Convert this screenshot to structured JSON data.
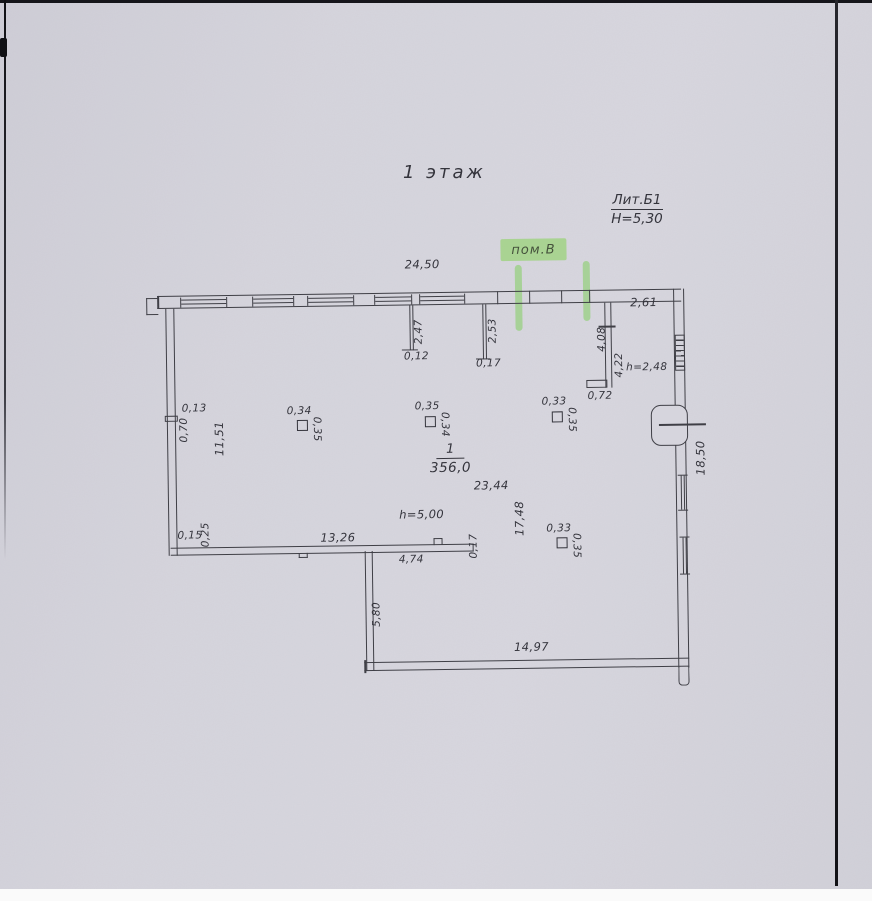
{
  "document": {
    "floor_title": "1 этаж",
    "liter": "Лит.Б1",
    "height_note": "H=5,30"
  },
  "highlight": {
    "label": "пом.В",
    "color": "#8ed264"
  },
  "room": {
    "number": "1",
    "area": "356,0",
    "height": "h=5,00",
    "length": "23,44",
    "width": "17,48"
  },
  "dims": {
    "top_width": "24,50",
    "partition1_len": "2,47",
    "partition1_thk": "0,12",
    "partition2_len": "2,53",
    "partition2_thk": "0,17",
    "corner_top": "2,61",
    "partition3_len_upper": "4,08",
    "partition3_len": "4,22",
    "vestibule_height": "h=2,48",
    "partition3_end": "0,72",
    "left_notch_depth": "0,13",
    "left_notch_len": "0,70",
    "left_wall_len": "11,51",
    "right_wall_len": "18,50",
    "sw_corner_a": "0,15",
    "sw_corner_b": "0,25",
    "bottom_left_len": "13,26",
    "bottom_mid_len": "4,74",
    "bottom_mid_thk": "0,17",
    "annex_wall_len": "5,80",
    "bottom_wall_len": "14,97"
  },
  "columns": [
    {
      "top": "0,34",
      "side": "0,35"
    },
    {
      "top": "0,35",
      "side": "0,34"
    },
    {
      "top": "0,33",
      "side": "0,35"
    },
    {
      "top": "0,33",
      "side": "0,35"
    }
  ]
}
